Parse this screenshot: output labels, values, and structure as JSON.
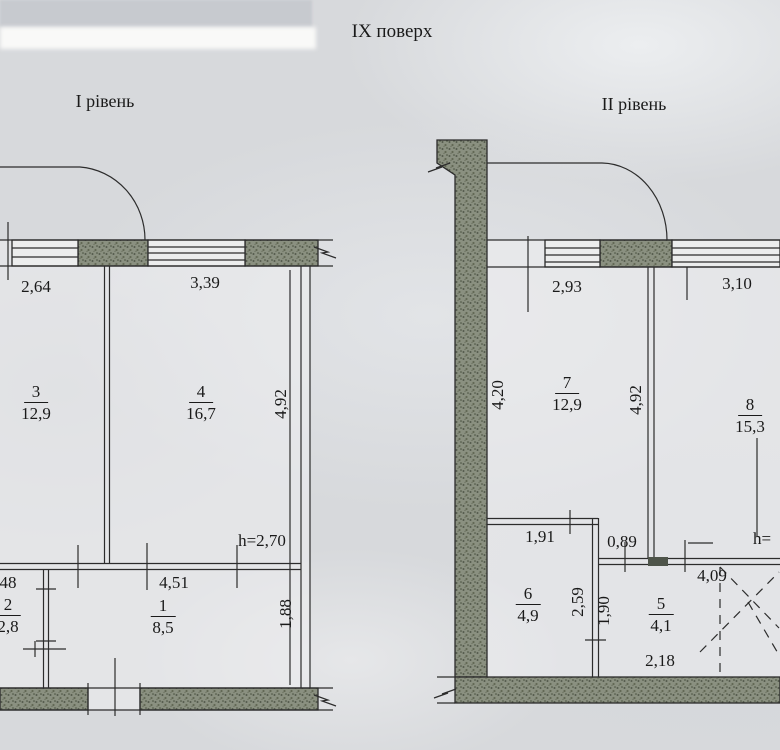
{
  "page": {
    "title": "ІХ поверх"
  },
  "colors": {
    "paper": "#d7d9dc",
    "ink": "#1a1a1a",
    "wall": "#8a9080"
  },
  "level1": {
    "label": "І рівень",
    "rooms": [
      {
        "number": "3",
        "area": "12,9"
      },
      {
        "number": "4",
        "area": "16,7"
      },
      {
        "number": "2",
        "area": "2,8"
      },
      {
        "number": "1",
        "area": "8,5"
      }
    ],
    "dims": {
      "top_left": "2,64",
      "top_right": "3,39",
      "right_v": "4,92",
      "height_note": "h=2,70",
      "hall_w": "4,51",
      "hall_v": "1,88",
      "left_cut": "48"
    }
  },
  "level2": {
    "label": "ІІ рівень",
    "rooms": [
      {
        "number": "7",
        "area": "12,9"
      },
      {
        "number": "8",
        "area": "15,3"
      },
      {
        "number": "6",
        "area": "4,9"
      },
      {
        "number": "5",
        "area": "4,1"
      }
    ],
    "dims": {
      "top_left": "2,93",
      "top_right": "3,10",
      "left_v": "4,20",
      "mid_v": "4,92",
      "room6_w": "1,91",
      "niche_w": "0,89",
      "hall_w": "4,09",
      "room6_v": "2,59",
      "wall_v": "1,90",
      "room5_w": "2,18",
      "height_note": "h="
    }
  }
}
